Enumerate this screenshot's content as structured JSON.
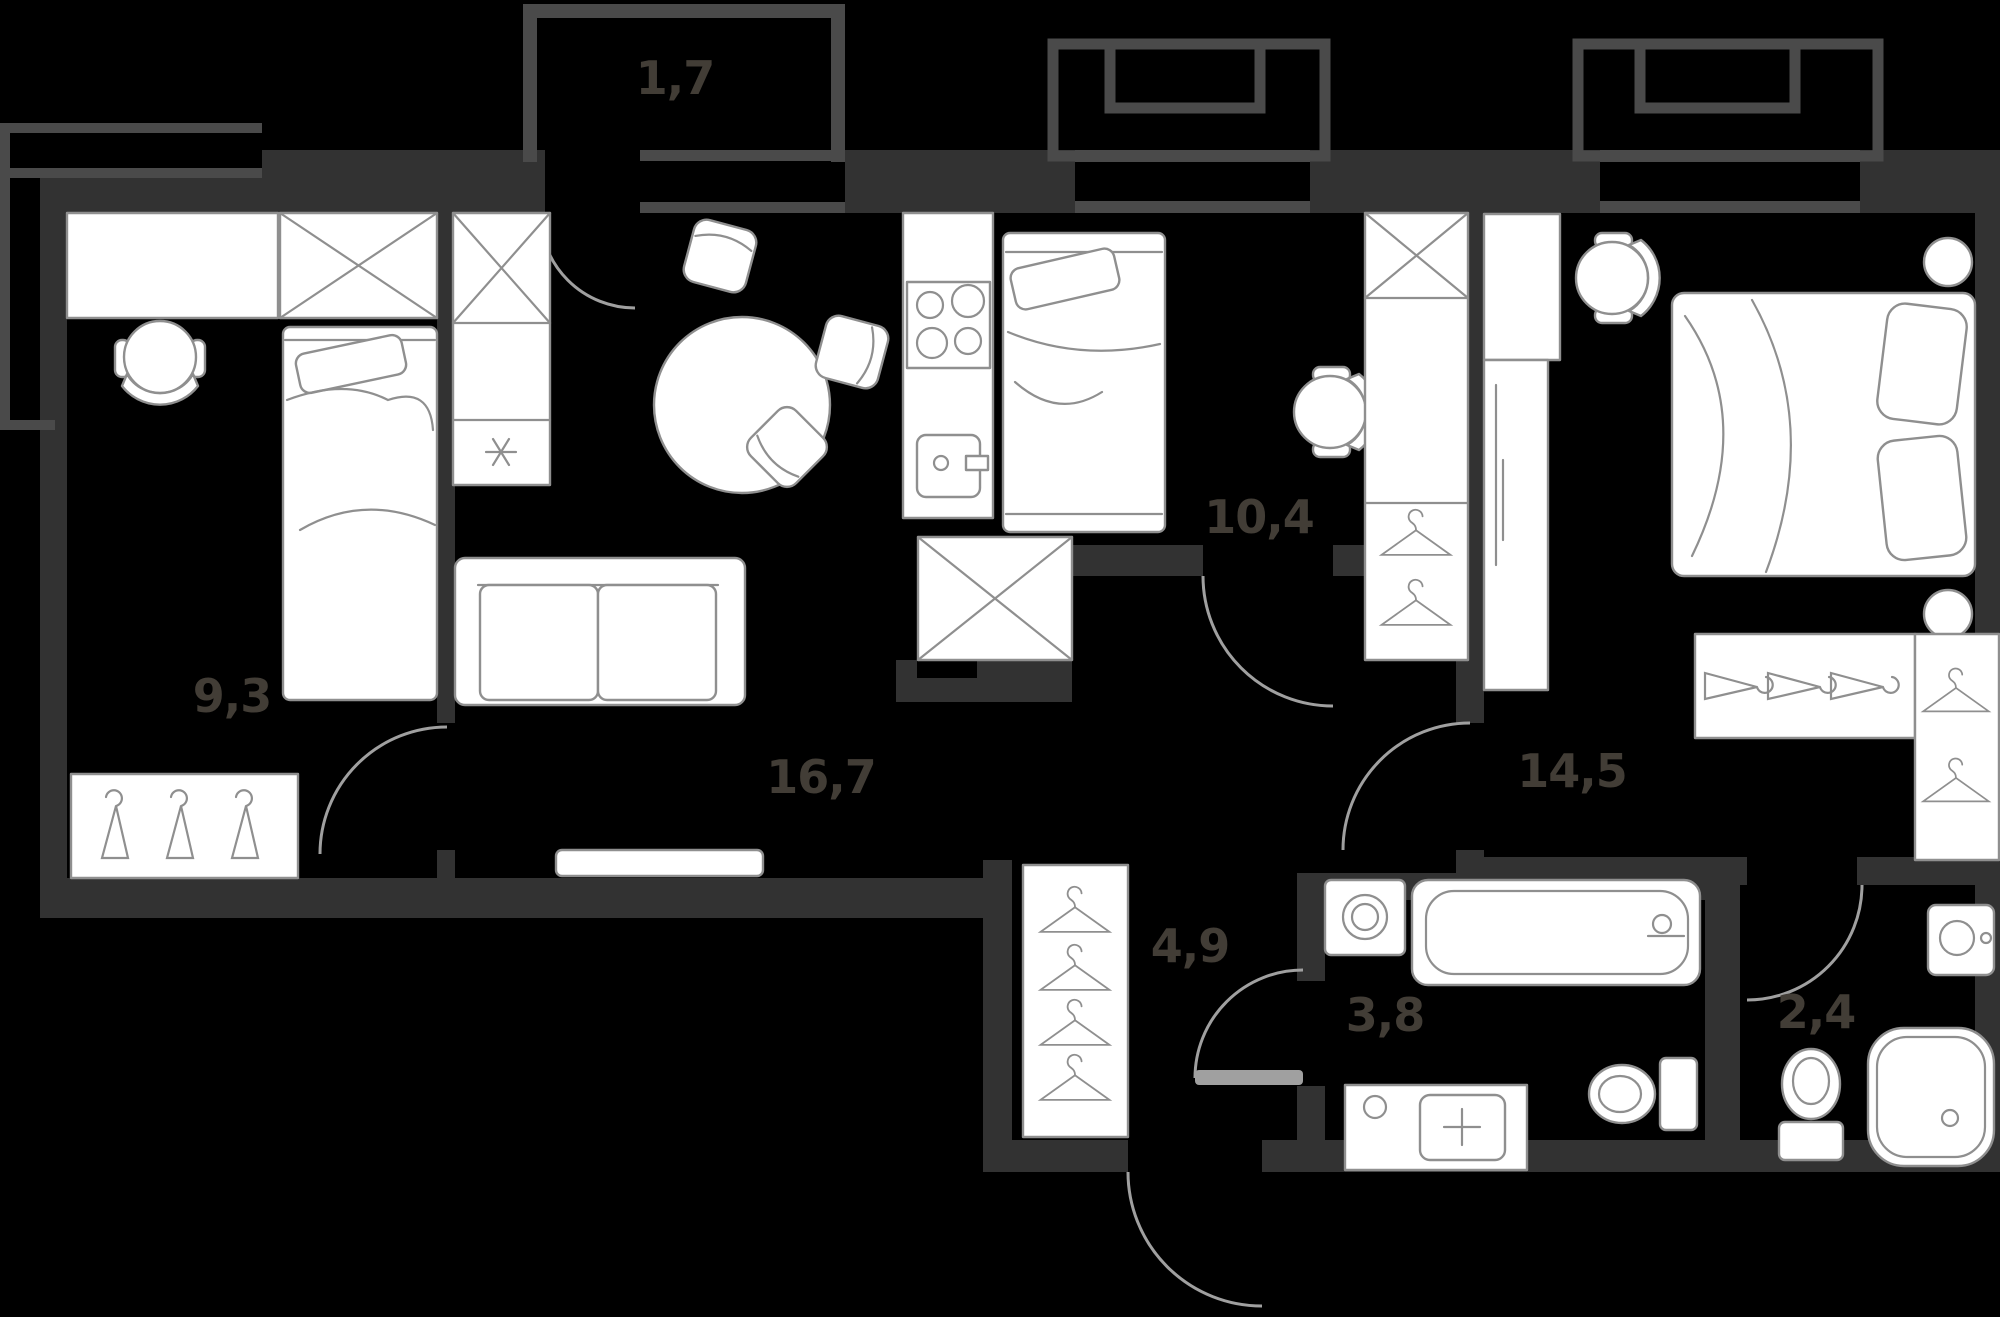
{
  "rooms": {
    "balcony": {
      "area": "1,7"
    },
    "bedroom_small": {
      "area": "9,3"
    },
    "living_room": {
      "area": "16,7"
    },
    "kitchen": {
      "area": "10,4"
    },
    "bedroom_main": {
      "area": "14,5"
    },
    "hallway": {
      "area": "4,9"
    },
    "bathroom": {
      "area": "3,8"
    },
    "wc": {
      "area": "2,4"
    }
  },
  "icons": {
    "fridge_marker": "asterisk-icon",
    "closet_marker": "x-cross-icon",
    "hanger_marker": "coat-hanger-icon"
  },
  "colors": {
    "background": "#000000",
    "wall": "#323232",
    "wall_light": "#4a4a4a",
    "furniture": "#ffffff",
    "outline": "#8f8f8f",
    "label": "#423d36",
    "arc": "#a0a0a0"
  }
}
